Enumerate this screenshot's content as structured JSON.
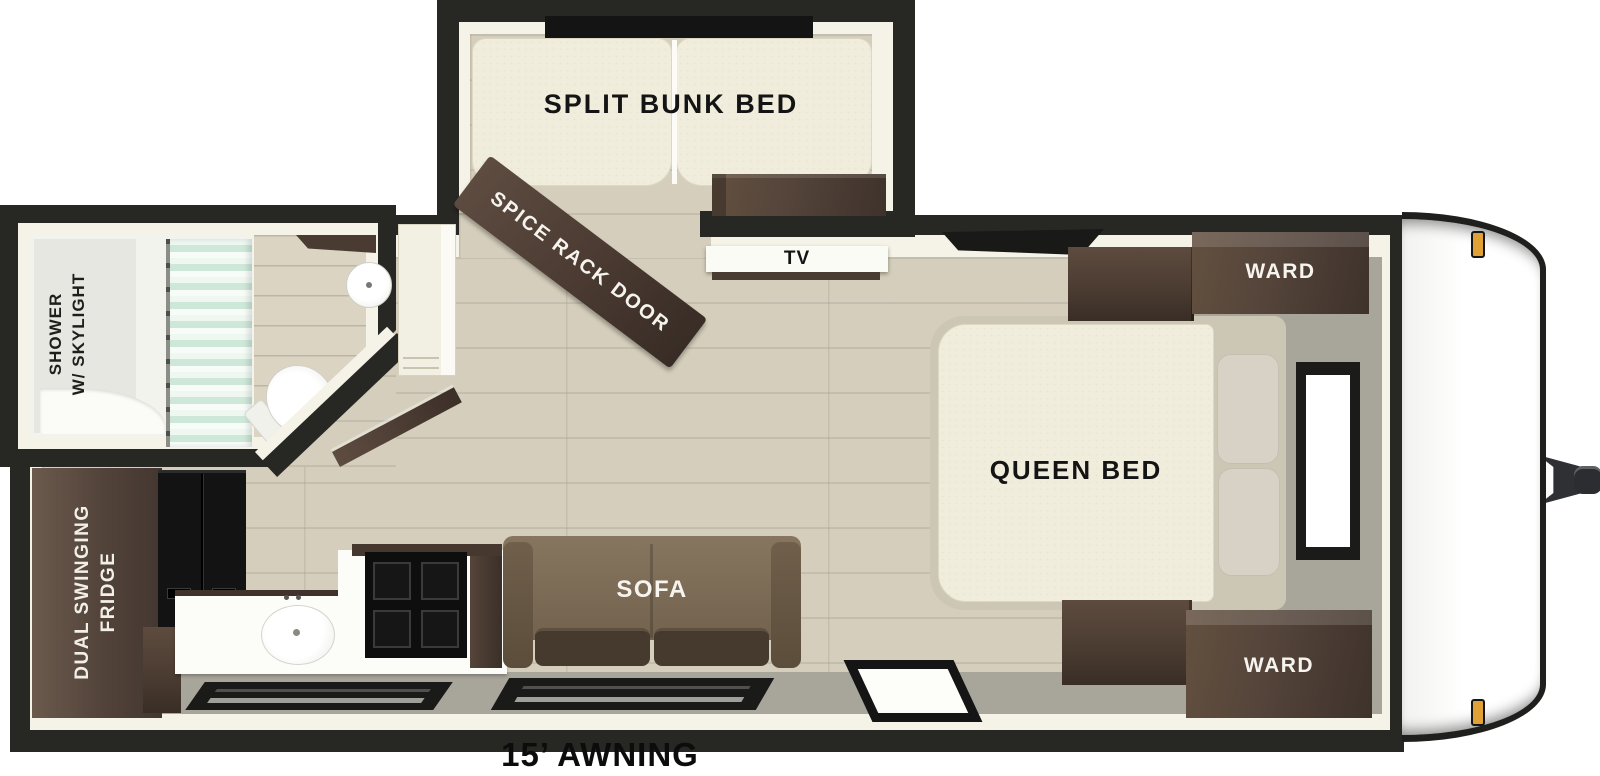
{
  "title": "Travel trailer floor plan",
  "labels": {
    "split_bunk_bed": "SPLIT BUNK BED",
    "spice_rack_door": "SPICE RACK DOOR",
    "tv": "TV",
    "ward_top": "WARD",
    "ward_bottom": "WARD",
    "queen_bed": "QUEEN BED",
    "sofa": "SOFA",
    "shower_line1": "SHOWER",
    "shower_line2": "W/ SKYLIGHT",
    "fridge_line1": "DUAL SWINGING",
    "fridge_line2": "FRIDGE",
    "awning": "15’ AWNING"
  },
  "colors": {
    "wall": "#272724",
    "wall_inner": "#f5f2e7",
    "floor_wood": "#d5cebc",
    "floor_gray": "#a8a59b",
    "cabinet_brown": "#54443a",
    "sofa_brown": "#7d6d59",
    "mattress_cream": "#f1eddd",
    "curtain_mint": "#cde7d8",
    "marker_light_orange": "#e2a135"
  }
}
